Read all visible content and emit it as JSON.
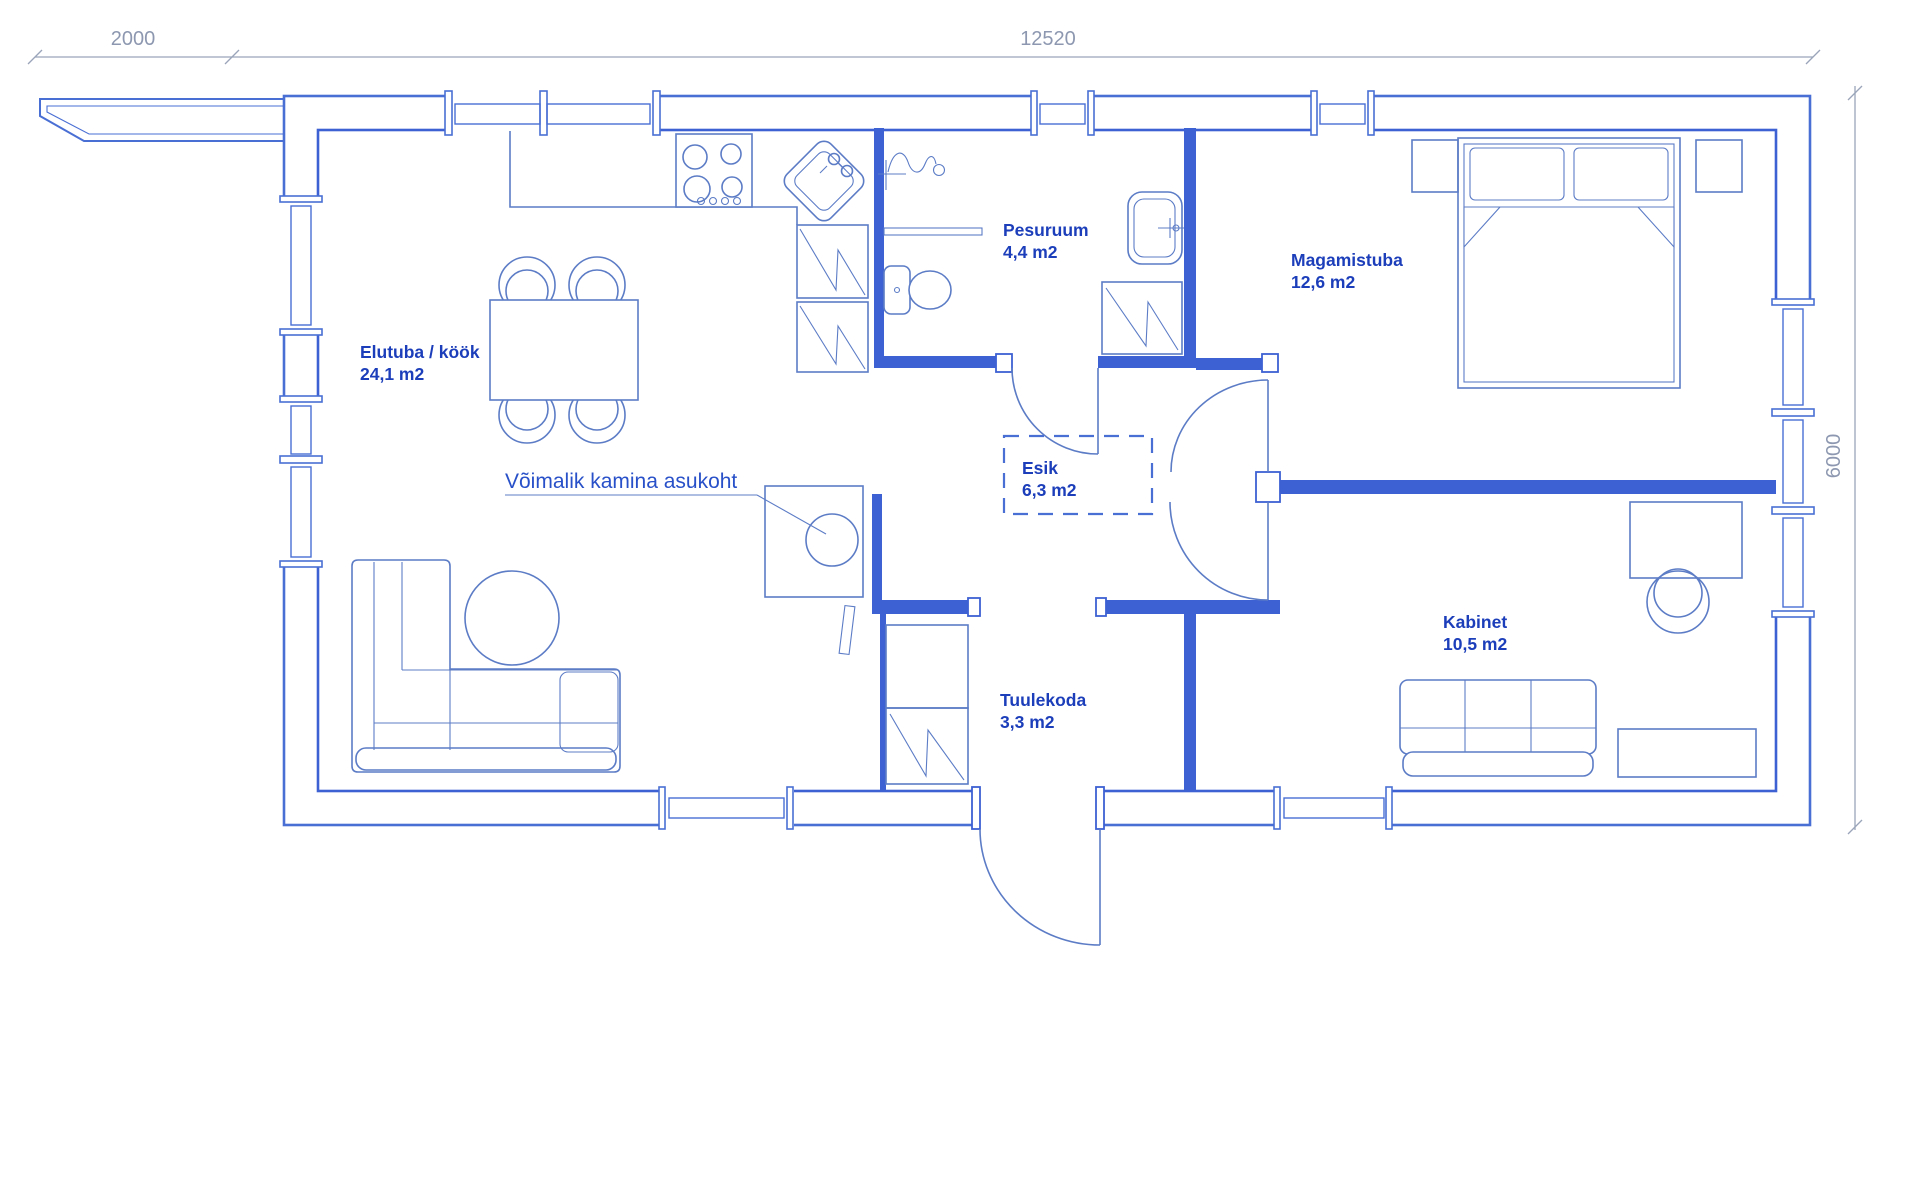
{
  "plan": {
    "type": "floor-plan",
    "rooms": [
      {
        "id": "elutuba",
        "name": "Elutuba / köök",
        "area": "24,1 m2"
      },
      {
        "id": "pesuruum",
        "name": "Pesuruum",
        "area": "4,4 m2"
      },
      {
        "id": "magamistuba",
        "name": "Magamistuba",
        "area": "12,6 m2"
      },
      {
        "id": "esik",
        "name": "Esik",
        "area": "6,3 m2"
      },
      {
        "id": "kabinet",
        "name": "Kabinet",
        "area": "10,5 m2"
      },
      {
        "id": "tuulekoda",
        "name": "Tuulekoda",
        "area": "3,3 m2"
      }
    ],
    "annotation": {
      "fireplace": "Võimalik kamina asukoht"
    },
    "dimensions": {
      "canopy_width_mm": "2000",
      "total_width_mm": "12520",
      "total_height_mm": "6000"
    },
    "colors": {
      "wall_blue": "#3d60d3",
      "outline_blue": "#4a6fd4",
      "fixture_blue": "#5c7cc6",
      "label_blue": "#1c3eba",
      "annotation_blue": "#2850c8",
      "dimension_gray": "#8d98b0",
      "background": "#ffffff"
    }
  }
}
